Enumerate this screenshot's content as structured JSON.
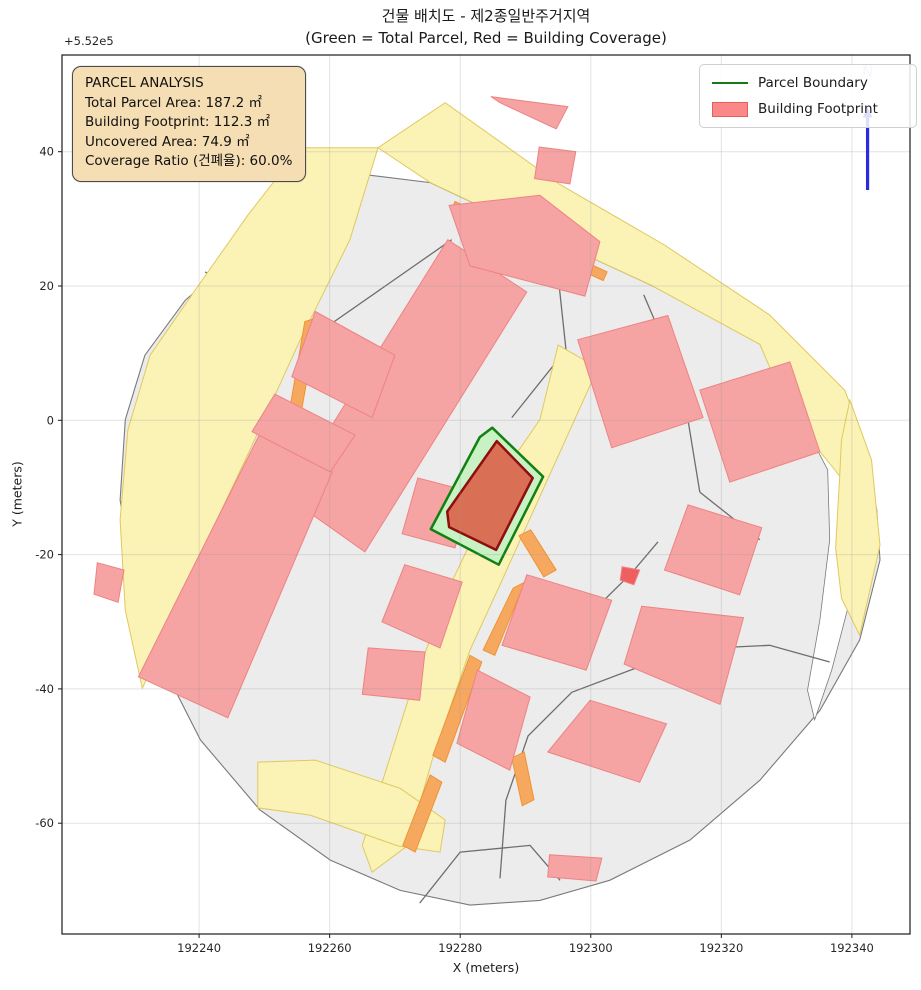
{
  "title": {
    "line1": "건물 배치도 - 제2종일반주거지역",
    "line2": "(Green = Total Parcel, Red = Building Coverage)"
  },
  "axes": {
    "x_label": "X (meters)",
    "y_label": "Y (meters)",
    "y_offset_label": "+5.52e5",
    "x_ticks": [
      192240,
      192260,
      192280,
      192300,
      192320,
      192340
    ],
    "y_ticks": [
      40,
      20,
      0,
      -20,
      -40,
      -60
    ],
    "x_range": [
      192219.0,
      192348.9
    ],
    "y_range": [
      -76.5,
      54.4
    ],
    "grid": true
  },
  "legend": {
    "items": [
      {
        "label": "Parcel Boundary",
        "swatch": "line",
        "color": "#157a15"
      },
      {
        "label": "Building Footprint",
        "swatch": "patch",
        "color": "#fb8888"
      }
    ]
  },
  "info_box": {
    "title": "PARCEL ANALYSIS",
    "lines": [
      "Total Parcel Area: 187.2 ㎡",
      "Building Footprint: 112.3 ㎡",
      "Uncovered Area: 74.9 ㎡",
      "Coverage Ratio (건폐율): 60.0%"
    ],
    "stats": {
      "total_parcel_area_m2": 187.2,
      "building_footprint_m2": 112.3,
      "uncovered_area_m2": 74.9,
      "coverage_ratio_pct": 60.0
    }
  },
  "north_arrow": {
    "label": "N",
    "x": 192342.4,
    "y_base": 34.3,
    "y_tip": 46.6,
    "label_y": 51.2,
    "color": "#2a2ae0",
    "label_color": "#b9b9f2"
  },
  "chart_data": {
    "type": "map",
    "title": "건물 배치도 - 제2종일반주거지역",
    "colors": {
      "landmass_fill": "#ececec",
      "landmass_edge": "#7a7a7a",
      "parcel_line": "#6e6e6e",
      "road_fill": "#fbf2b6",
      "road_edge": "#dfc95f",
      "orange_fill": "#f6a85f",
      "orange_edge": "#ee9434",
      "building_fill": "#f5a3a3",
      "building_edge": "#ee8383",
      "highlight_parcel_fill": "#c8f2c4",
      "highlight_parcel_edge": "#128012",
      "highlight_building_fill": "#d96f55",
      "highlight_building_edge": "#8e0e0e",
      "grid": "#9a9a9a",
      "white_gap": "#ffffff"
    },
    "landmass": [
      [
        192259.3,
        37.3
      ],
      [
        192275.4,
        35.4
      ],
      [
        192289.2,
        29.1
      ],
      [
        192309.1,
        20.2
      ],
      [
        192325.9,
        12.0
      ],
      [
        192337.8,
        4.5
      ],
      [
        192341.5,
        -2.9
      ],
      [
        192343.8,
        -13.3
      ],
      [
        192344.3,
        -20.8
      ],
      [
        192341.2,
        -32.7
      ],
      [
        192335.1,
        -43.2
      ],
      [
        192325.9,
        -53.6
      ],
      [
        192315.2,
        -62.5
      ],
      [
        192302.9,
        -68.5
      ],
      [
        192292.2,
        -71.5
      ],
      [
        192281.5,
        -72.2
      ],
      [
        192270.8,
        -70.0
      ],
      [
        192260.1,
        -65.5
      ],
      [
        192249.3,
        -58.0
      ],
      [
        192240.2,
        -47.6
      ],
      [
        192234.0,
        -35.7
      ],
      [
        192230.2,
        -23.8
      ],
      [
        192227.9,
        -11.9
      ],
      [
        192228.7,
        0.1
      ],
      [
        192231.7,
        9.7
      ],
      [
        192237.9,
        17.9
      ],
      [
        192247.0,
        25.4
      ],
      [
        192257.0,
        31.4
      ]
    ],
    "white_gaps": [
      [
        [
          192337.1,
          3.8
        ],
        [
          192340.1,
          -3.7
        ],
        [
          192341.2,
          -14.8
        ],
        [
          192339.7,
          -26.8
        ],
        [
          192336.9,
          -37.2
        ],
        [
          192334.3,
          -44.6
        ],
        [
          192333.2,
          -40.2
        ],
        [
          192335.1,
          -29.7
        ],
        [
          192336.6,
          -17.8
        ],
        [
          192336.3,
          -7.4
        ],
        [
          192333.9,
          -2.9
        ],
        [
          192332.0,
          -1.1
        ]
      ]
    ],
    "parcel_lines": [
      [
        [
          192240.9,
          22.1
        ],
        [
          192258.8,
          13.2
        ]
      ],
      [
        [
          192232.8,
          -34.2
        ],
        [
          192249.6,
          -20.5
        ]
      ],
      [
        [
          192278.7,
          26.9
        ],
        [
          192258.2,
          13.0
        ]
      ],
      [
        [
          192294.7,
          24.2
        ],
        [
          192296.2,
          10.5
        ],
        [
          192287.9,
          0.4
        ]
      ],
      [
        [
          192308.1,
          18.7
        ],
        [
          192314.0,
          5.3
        ],
        [
          192316.7,
          -10.7
        ]
      ],
      [
        [
          192286.1,
          -68.2
        ],
        [
          192287.0,
          -56.6
        ],
        [
          192290.4,
          -47.0
        ],
        [
          192297.1,
          -40.5
        ],
        [
          192306.9,
          -36.9
        ],
        [
          192319.2,
          -33.9
        ],
        [
          192327.4,
          -33.5
        ],
        [
          192336.6,
          -36.0
        ]
      ],
      [
        [
          192295.0,
          -33.5
        ],
        [
          192306.3,
          -22.7
        ],
        [
          192310.3,
          -18.1
        ]
      ],
      [
        [
          192316.7,
          -10.7
        ],
        [
          192325.9,
          -17.8
        ]
      ],
      [
        [
          192273.8,
          -71.9
        ],
        [
          192280.0,
          -64.3
        ],
        [
          192290.7,
          -63.3
        ],
        [
          192295.3,
          -68.5
        ]
      ]
    ],
    "roads": [
      [
        [
          192255.5,
          40.6
        ],
        [
          192267.4,
          40.6
        ],
        [
          192263.1,
          26.9
        ],
        [
          192255.5,
          12.0
        ],
        [
          192247.8,
          -4.4
        ],
        [
          192240.9,
          -18.6
        ],
        [
          192234.8,
          -32.7
        ],
        [
          192231.3,
          -39.9
        ],
        [
          192228.7,
          -28.3
        ],
        [
          192227.9,
          -14.8
        ],
        [
          192229.1,
          -1.4
        ],
        [
          192232.5,
          9.7
        ],
        [
          192239.4,
          19.4
        ],
        [
          192247.5,
          30.6
        ]
      ],
      [
        [
          192267.4,
          40.6
        ],
        [
          192277.7,
          47.3
        ],
        [
          192295.3,
          35.1
        ],
        [
          192311.3,
          26.1
        ],
        [
          192327.4,
          15.7
        ],
        [
          192338.9,
          4.5
        ],
        [
          192342.4,
          -4.4
        ],
        [
          192343.5,
          -12.6
        ],
        [
          192340.4,
          -11.1
        ],
        [
          192337.4,
          -7.4
        ],
        [
          192334.3,
          -3.7
        ],
        [
          192331.2,
          -0.7
        ],
        [
          192325.9,
          11.3
        ],
        [
          192309.1,
          20.2
        ],
        [
          192289.2,
          29.1
        ],
        [
          192275.4,
          35.4
        ]
      ],
      [
        [
          192339.7,
          3.0
        ],
        [
          192343.0,
          -5.9
        ],
        [
          192344.3,
          -18.6
        ],
        [
          192341.2,
          -32.0
        ],
        [
          192338.4,
          -26.5
        ],
        [
          192337.5,
          -19.0
        ],
        [
          192338.1,
          -8.9
        ],
        [
          192338.4,
          -2.9
        ]
      ],
      [
        [
          192295.0,
          11.2
        ],
        [
          192301.1,
          7.8
        ],
        [
          192286.1,
          -24.5
        ],
        [
          192281.5,
          -34.2
        ],
        [
          192275.7,
          -50.6
        ],
        [
          192272.0,
          -63.3
        ],
        [
          192266.5,
          -67.3
        ],
        [
          192265.0,
          -63.3
        ],
        [
          192272.0,
          -41.7
        ],
        [
          192278.1,
          -25.3
        ],
        [
          192286.9,
          -7.4
        ],
        [
          192292.2,
          0.1
        ]
      ],
      [
        [
          192249.0,
          -50.9
        ],
        [
          192257.8,
          -50.6
        ],
        [
          192270.8,
          -54.8
        ],
        [
          192277.7,
          -59.5
        ],
        [
          192276.9,
          -64.3
        ],
        [
          192270.5,
          -63.4
        ],
        [
          192257.0,
          -58.8
        ],
        [
          192249.0,
          -57.7
        ]
      ]
    ],
    "orange_strips": [
      [
        [
          192256.2,
          14.7
        ],
        [
          192258.2,
          15.3
        ],
        [
          192255.5,
          0.4
        ],
        [
          192253.6,
          0.1
        ]
      ],
      [
        [
          192251.2,
          -4.4
        ],
        [
          192253.6,
          -3.8
        ],
        [
          192242.9,
          -28.6
        ],
        [
          192240.8,
          -27.8
        ]
      ],
      [
        [
          192279.2,
          32.6
        ],
        [
          192302.5,
          22.1
        ],
        [
          192301.9,
          20.8
        ],
        [
          192278.6,
          31.2
        ]
      ],
      [
        [
          192281.5,
          -35.0
        ],
        [
          192283.3,
          -36.0
        ],
        [
          192277.7,
          -50.9
        ],
        [
          192275.8,
          -49.9
        ]
      ],
      [
        [
          192275.4,
          -52.8
        ],
        [
          192277.2,
          -53.9
        ],
        [
          192273.1,
          -64.3
        ],
        [
          192271.2,
          -63.3
        ]
      ],
      [
        [
          192288.1,
          -25.0
        ],
        [
          192289.9,
          -24.1
        ],
        [
          192285.3,
          -35.0
        ],
        [
          192283.5,
          -34.2
        ]
      ],
      [
        [
          192289.0,
          -17.2
        ],
        [
          192290.8,
          -16.3
        ],
        [
          192294.7,
          -22.3
        ],
        [
          192292.8,
          -23.3
        ]
      ],
      [
        [
          192287.9,
          -50.3
        ],
        [
          192289.8,
          -49.4
        ],
        [
          192291.3,
          -56.5
        ],
        [
          192289.5,
          -57.4
        ]
      ]
    ],
    "buildings": [
      {
        "pts": [
          [
            192253.5,
            -11.4
          ],
          [
            192278.1,
            26.9
          ],
          [
            192290.2,
            19.1
          ],
          [
            192265.4,
            -19.6
          ]
        ]
      },
      {
        "pts": [
          [
            192278.3,
            32.0
          ],
          [
            192292.2,
            33.5
          ],
          [
            192301.4,
            26.6
          ],
          [
            192299.1,
            18.5
          ],
          [
            192281.5,
            23.0
          ]
        ]
      },
      {
        "pts": [
          [
            192284.7,
            48.2
          ],
          [
            192296.5,
            46.7
          ],
          [
            192294.7,
            43.4
          ],
          [
            192286.1,
            47.3
          ]
        ]
      },
      {
        "pts": [
          [
            192292.1,
            40.7
          ],
          [
            192297.7,
            40.0
          ],
          [
            192296.8,
            35.2
          ],
          [
            192291.4,
            36.0
          ]
        ]
      },
      {
        "pts": [
          [
            192298.0,
            12.0
          ],
          [
            192311.8,
            15.6
          ],
          [
            192317.2,
            0.4
          ],
          [
            192303.2,
            -4.1
          ]
        ]
      },
      {
        "pts": [
          [
            192316.7,
            4.5
          ],
          [
            192330.5,
            8.7
          ],
          [
            192335.1,
            -4.7
          ],
          [
            192321.3,
            -9.2
          ]
        ]
      },
      {
        "pts": [
          [
            192314.9,
            -12.6
          ],
          [
            192326.2,
            -16.0
          ],
          [
            192322.8,
            -26.0
          ],
          [
            192311.3,
            -22.3
          ]
        ]
      },
      {
        "pts": [
          [
            192307.8,
            -27.7
          ],
          [
            192323.4,
            -29.4
          ],
          [
            192319.8,
            -42.3
          ],
          [
            192305.1,
            -36.3
          ]
        ]
      },
      {
        "pts": [
          [
            192290.2,
            -23.0
          ],
          [
            192303.2,
            -26.8
          ],
          [
            192299.3,
            -37.2
          ],
          [
            192286.4,
            -33.5
          ]
        ]
      },
      {
        "pts": [
          [
            192282.6,
            -37.2
          ],
          [
            192290.7,
            -41.2
          ],
          [
            192287.6,
            -52.1
          ],
          [
            192279.5,
            -48.1
          ]
        ]
      },
      {
        "pts": [
          [
            192299.9,
            -41.7
          ],
          [
            192311.6,
            -45.2
          ],
          [
            192307.5,
            -53.9
          ],
          [
            192293.4,
            -49.4
          ]
        ]
      },
      {
        "pts": [
          [
            192293.7,
            -64.7
          ],
          [
            192301.7,
            -65.2
          ],
          [
            192300.8,
            -68.6
          ],
          [
            192293.4,
            -68.0
          ]
        ]
      },
      {
        "pts": [
          [
            192249.6,
            -1.4
          ],
          [
            192260.4,
            -7.7
          ],
          [
            192244.4,
            -44.3
          ],
          [
            192230.7,
            -38.2
          ]
        ]
      },
      {
        "pts": [
          [
            192265.9,
            -33.9
          ],
          [
            192274.6,
            -34.5
          ],
          [
            192273.8,
            -41.7
          ],
          [
            192265.0,
            -40.8
          ]
        ]
      },
      {
        "pts": [
          [
            192271.5,
            -21.5
          ],
          [
            192280.3,
            -24.1
          ],
          [
            192276.9,
            -33.9
          ],
          [
            192268.0,
            -30.0
          ]
        ]
      },
      {
        "pts": [
          [
            192273.5,
            -8.6
          ],
          [
            192281.8,
            -10.7
          ],
          [
            192279.2,
            -19.0
          ],
          [
            192271.1,
            -16.9
          ]
        ]
      },
      {
        "pts": [
          [
            192257.8,
            16.2
          ],
          [
            192270.0,
            9.7
          ],
          [
            192266.5,
            0.4
          ],
          [
            192254.2,
            6.5
          ]
        ]
      },
      {
        "pts": [
          [
            192251.6,
            3.9
          ],
          [
            192263.9,
            -2.2
          ],
          [
            192260.1,
            -7.7
          ],
          [
            192248.1,
            -1.7
          ]
        ]
      },
      {
        "pts": [
          [
            192224.4,
            -21.2
          ],
          [
            192228.5,
            -22.3
          ],
          [
            192227.6,
            -27.1
          ],
          [
            192223.9,
            -25.9
          ]
        ]
      },
      {
        "pts": [
          [
            192304.8,
            -21.8
          ],
          [
            192307.5,
            -22.3
          ],
          [
            192306.6,
            -24.5
          ],
          [
            192304.5,
            -23.8
          ]
        ],
        "fill": "#ef5f5f"
      }
    ],
    "highlight_parcel": [
      [
        192284.9,
        -1.1
      ],
      [
        192292.7,
        -8.4
      ],
      [
        192285.9,
        -21.5
      ],
      [
        192275.5,
        -16.2
      ],
      [
        192283.0,
        -2.5
      ]
    ],
    "highlight_building": [
      [
        192285.6,
        -3.1
      ],
      [
        192291.1,
        -8.6
      ],
      [
        192285.5,
        -19.3
      ],
      [
        192278.3,
        -15.9
      ],
      [
        192278.0,
        -13.6
      ]
    ]
  }
}
